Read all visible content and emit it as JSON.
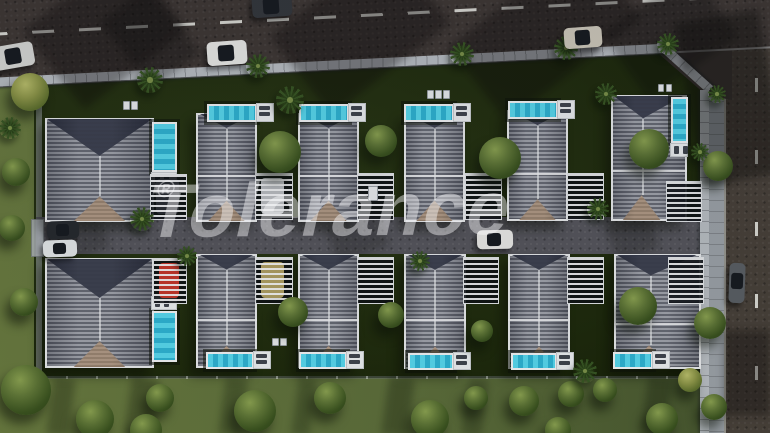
{
  "scene": {
    "type": "aerial-3d-render",
    "subject": "Gated residential complex of twelve detached villas with private pools, slatted carport pergolas, palm trees, an internal street, perimeter wall, main road with traffic at top and side road at right",
    "watermark": {
      "text": "Tolerance",
      "registered_mark": "®"
    }
  },
  "palette": {
    "main_road": "#3e3734",
    "side_road": "#474039",
    "inner_road": "#55555c",
    "sidewalk": "#9aa0a6",
    "wall": "#b7bcc1",
    "lawn_inner": "#202c0e",
    "lawn_outer": "#5b6c3a",
    "roof_stripe_light": "#9a9da6",
    "roof_stripe_dark": "#5e616c",
    "roof_gable_dark": "#2f3343",
    "roof_gable_tan": "#ab937e",
    "pool_water": "#3fc8e2",
    "pool_deck": "#e9ecee",
    "pergola_slat": "#f0f1f3",
    "lane_marking": "#d8d8d2",
    "tree_green": "#4e6530",
    "palm_green": "#33501f",
    "watermark_color": "rgba(250,250,252,0.45)"
  },
  "villas": [
    {
      "id": "villa-1",
      "row": "top",
      "x": 45,
      "y": 118,
      "w": 105,
      "h": 100,
      "type": "big"
    },
    {
      "id": "villa-2",
      "row": "top",
      "x": 196,
      "y": 113,
      "w": 57,
      "h": 105,
      "type": "std"
    },
    {
      "id": "villa-3",
      "row": "top",
      "x": 298,
      "y": 113,
      "w": 57,
      "h": 105,
      "type": "std"
    },
    {
      "id": "villa-4",
      "row": "top",
      "x": 404,
      "y": 113,
      "w": 57,
      "h": 105,
      "type": "std"
    },
    {
      "id": "villa-5",
      "row": "top",
      "x": 507,
      "y": 110,
      "w": 57,
      "h": 107,
      "type": "std"
    },
    {
      "id": "villa-6",
      "row": "top",
      "x": 611,
      "y": 95,
      "w": 72,
      "h": 122,
      "type": "wide"
    },
    {
      "id": "villa-7",
      "row": "bottom",
      "x": 45,
      "y": 258,
      "w": 105,
      "h": 106,
      "type": "big"
    },
    {
      "id": "villa-8",
      "row": "bottom",
      "x": 196,
      "y": 254,
      "w": 57,
      "h": 110,
      "type": "std"
    },
    {
      "id": "villa-9",
      "row": "bottom",
      "x": 298,
      "y": 254,
      "w": 57,
      "h": 110,
      "type": "std"
    },
    {
      "id": "villa-10",
      "row": "bottom",
      "x": 404,
      "y": 254,
      "w": 58,
      "h": 111,
      "type": "std"
    },
    {
      "id": "villa-11",
      "row": "bottom",
      "x": 508,
      "y": 254,
      "w": 58,
      "h": 111,
      "type": "std"
    },
    {
      "id": "villa-12",
      "row": "bottom",
      "x": 614,
      "y": 254,
      "w": 83,
      "h": 111,
      "type": "wide"
    }
  ],
  "pools": [
    {
      "x": 152,
      "y": 122,
      "w": 21,
      "h": 46,
      "deck": "bottom"
    },
    {
      "x": 207,
      "y": 104,
      "w": 46,
      "h": 14,
      "deck": "right"
    },
    {
      "x": 299,
      "y": 104,
      "w": 46,
      "h": 14,
      "deck": "right"
    },
    {
      "x": 404,
      "y": 104,
      "w": 46,
      "h": 14,
      "deck": "right"
    },
    {
      "x": 508,
      "y": 101,
      "w": 46,
      "h": 14,
      "deck": "right"
    },
    {
      "x": 671,
      "y": 97,
      "w": 13,
      "h": 42,
      "deck": "bottom"
    },
    {
      "x": 152,
      "y": 311,
      "w": 21,
      "h": 47,
      "deck": "top"
    },
    {
      "x": 206,
      "y": 352,
      "w": 44,
      "h": 13,
      "deck": "right"
    },
    {
      "x": 299,
      "y": 352,
      "w": 44,
      "h": 13,
      "deck": "right"
    },
    {
      "x": 408,
      "y": 353,
      "w": 42,
      "h": 13,
      "deck": "right"
    },
    {
      "x": 511,
      "y": 353,
      "w": 42,
      "h": 13,
      "deck": "right"
    },
    {
      "x": 613,
      "y": 352,
      "w": 36,
      "h": 13,
      "deck": "right"
    }
  ],
  "pergolas": [
    {
      "x": 150,
      "y": 174,
      "w": 35,
      "h": 44,
      "car": "#2a2d33"
    },
    {
      "x": 255,
      "y": 173,
      "w": 36,
      "h": 45,
      "car": "#b9bcc0"
    },
    {
      "x": 357,
      "y": 173,
      "w": 35,
      "h": 45
    },
    {
      "x": 465,
      "y": 173,
      "w": 35,
      "h": 45
    },
    {
      "x": 567,
      "y": 173,
      "w": 35,
      "h": 45
    },
    {
      "x": 666,
      "y": 181,
      "w": 34,
      "h": 39
    },
    {
      "x": 153,
      "y": 258,
      "w": 32,
      "h": 44,
      "car": "#c23529"
    },
    {
      "x": 255,
      "y": 257,
      "w": 36,
      "h": 45,
      "car": "#ad9d62"
    },
    {
      "x": 357,
      "y": 257,
      "w": 35,
      "h": 45
    },
    {
      "x": 463,
      "y": 257,
      "w": 34,
      "h": 45
    },
    {
      "x": 567,
      "y": 257,
      "w": 35,
      "h": 45
    },
    {
      "x": 668,
      "y": 257,
      "w": 34,
      "h": 45
    }
  ],
  "cars": [
    {
      "x": -6,
      "y": 44,
      "w": 40,
      "h": 24,
      "angle": -10,
      "color": "#d6d7d4",
      "location": "main-road"
    },
    {
      "x": 252,
      "y": -5,
      "w": 40,
      "h": 22,
      "angle": -4,
      "color": "#34373c",
      "location": "main-road"
    },
    {
      "x": 207,
      "y": 41,
      "w": 40,
      "h": 24,
      "angle": -4,
      "color": "#e9e9e6",
      "location": "main-road"
    },
    {
      "x": 564,
      "y": 27,
      "w": 38,
      "h": 21,
      "angle": -4,
      "color": "#cdc8ba",
      "location": "main-road"
    },
    {
      "x": 729,
      "y": 263,
      "w": 16,
      "h": 40,
      "angle": 2,
      "color": "#595e63",
      "location": "side-road"
    },
    {
      "x": 477,
      "y": 230,
      "w": 36,
      "h": 19,
      "angle": -1,
      "color": "#e8e8e5",
      "location": "inner-road"
    },
    {
      "x": 47,
      "y": 221,
      "w": 32,
      "h": 18,
      "angle": -2,
      "color": "#26292e",
      "location": "inner-road"
    },
    {
      "x": 43,
      "y": 240,
      "w": 34,
      "h": 17,
      "angle": -2,
      "color": "#e2e5e7",
      "location": "inner-road"
    }
  ],
  "trees": {
    "palms": [
      {
        "x": 150,
        "y": 80,
        "r": 13
      },
      {
        "x": 258,
        "y": 66,
        "r": 12
      },
      {
        "x": 462,
        "y": 54,
        "r": 12
      },
      {
        "x": 566,
        "y": 48,
        "r": 12
      },
      {
        "x": 668,
        "y": 44,
        "r": 11
      },
      {
        "x": 290,
        "y": 100,
        "r": 14
      },
      {
        "x": 606,
        "y": 94,
        "r": 11
      },
      {
        "x": 717,
        "y": 94,
        "r": 9
      },
      {
        "x": 10,
        "y": 128,
        "r": 11
      },
      {
        "x": 142,
        "y": 219,
        "r": 12
      },
      {
        "x": 187,
        "y": 256,
        "r": 10
      },
      {
        "x": 420,
        "y": 261,
        "r": 10
      },
      {
        "x": 598,
        "y": 209,
        "r": 11
      },
      {
        "x": 585,
        "y": 371,
        "r": 12
      },
      {
        "x": 700,
        "y": 152,
        "r": 9
      }
    ],
    "round": [
      {
        "x": 280,
        "y": 152,
        "r": 21
      },
      {
        "x": 381,
        "y": 141,
        "r": 16
      },
      {
        "x": 500,
        "y": 158,
        "r": 21
      },
      {
        "x": 649,
        "y": 149,
        "r": 20
      },
      {
        "x": 293,
        "y": 312,
        "r": 15
      },
      {
        "x": 391,
        "y": 315,
        "r": 13
      },
      {
        "x": 638,
        "y": 306,
        "r": 19
      },
      {
        "x": 482,
        "y": 331,
        "r": 11
      },
      {
        "x": 718,
        "y": 166,
        "r": 15
      },
      {
        "x": 710,
        "y": 323,
        "r": 16
      },
      {
        "x": 30,
        "y": 92,
        "r": 19,
        "variant": "light"
      },
      {
        "x": 16,
        "y": 172,
        "r": 14
      },
      {
        "x": 12,
        "y": 228,
        "r": 13
      },
      {
        "x": 24,
        "y": 302,
        "r": 14
      },
      {
        "x": 26,
        "y": 390,
        "r": 25
      },
      {
        "x": 95,
        "y": 419,
        "r": 19
      },
      {
        "x": 160,
        "y": 398,
        "r": 14
      },
      {
        "x": 255,
        "y": 411,
        "r": 21
      },
      {
        "x": 330,
        "y": 398,
        "r": 16
      },
      {
        "x": 430,
        "y": 419,
        "r": 19
      },
      {
        "x": 524,
        "y": 401,
        "r": 15
      },
      {
        "x": 571,
        "y": 394,
        "r": 13
      },
      {
        "x": 605,
        "y": 390,
        "r": 12
      },
      {
        "x": 662,
        "y": 419,
        "r": 16
      },
      {
        "x": 714,
        "y": 407,
        "r": 13
      },
      {
        "x": 146,
        "y": 430,
        "r": 16
      },
      {
        "x": 558,
        "y": 430,
        "r": 13
      },
      {
        "x": 476,
        "y": 398,
        "r": 12
      },
      {
        "x": 690,
        "y": 380,
        "r": 12,
        "variant": "light"
      }
    ]
  },
  "utility_boxes": [
    {
      "x": 123,
      "y": 101,
      "w": 5,
      "h": 7
    },
    {
      "x": 131,
      "y": 101,
      "w": 5,
      "h": 7
    },
    {
      "x": 427,
      "y": 90,
      "w": 5,
      "h": 7
    },
    {
      "x": 435,
      "y": 90,
      "w": 5,
      "h": 7
    },
    {
      "x": 443,
      "y": 90,
      "w": 5,
      "h": 7
    },
    {
      "x": 658,
      "y": 84,
      "w": 4,
      "h": 6
    },
    {
      "x": 666,
      "y": 84,
      "w": 4,
      "h": 6
    },
    {
      "x": 272,
      "y": 338,
      "w": 5,
      "h": 6
    },
    {
      "x": 280,
      "y": 338,
      "w": 5,
      "h": 6
    },
    {
      "x": 368,
      "y": 186,
      "w": 8,
      "h": 13
    }
  ],
  "road_shadows": [
    {
      "x": 40,
      "y": -20,
      "w": 130,
      "h": 100,
      "angle": -38,
      "opacity": 0.35
    },
    {
      "x": 120,
      "y": -5,
      "w": 60,
      "h": 85,
      "angle": -38,
      "opacity": 0.3
    },
    {
      "x": 285,
      "y": -20,
      "w": 150,
      "h": 100,
      "angle": -38,
      "opacity": 0.35
    },
    {
      "x": 460,
      "y": -15,
      "w": 170,
      "h": 95,
      "angle": -38,
      "opacity": 0.35
    },
    {
      "x": 615,
      "y": -5,
      "w": 110,
      "h": 80,
      "angle": -35,
      "opacity": 0.3
    },
    {
      "x": 688,
      "y": 15,
      "w": 85,
      "h": 165,
      "angle": -10,
      "opacity": 0.4
    },
    {
      "x": 724,
      "y": 330,
      "w": 46,
      "h": 85,
      "angle": 0,
      "opacity": 0.35
    },
    {
      "x": 60,
      "y": 218,
      "w": 45,
      "h": 38,
      "angle": -20,
      "opacity": 0.22
    },
    {
      "x": 330,
      "y": 218,
      "w": 55,
      "h": 38,
      "angle": -20,
      "opacity": 0.22
    },
    {
      "x": 610,
      "y": 218,
      "w": 45,
      "h": 38,
      "angle": -20,
      "opacity": 0.22
    }
  ],
  "lawn_shadows": [
    {
      "x": 50,
      "y": 378,
      "w": 22,
      "h": 58,
      "angle": 8,
      "opacity": 0.3
    },
    {
      "x": 128,
      "y": 378,
      "w": 28,
      "h": 58,
      "angle": 8,
      "opacity": 0.3
    },
    {
      "x": 222,
      "y": 378,
      "w": 22,
      "h": 58,
      "angle": 8,
      "opacity": 0.28
    },
    {
      "x": 295,
      "y": 378,
      "w": 18,
      "h": 58,
      "angle": 8,
      "opacity": 0.28
    },
    {
      "x": 385,
      "y": 378,
      "w": 26,
      "h": 58,
      "angle": 8,
      "opacity": 0.3
    },
    {
      "x": 465,
      "y": 378,
      "w": 20,
      "h": 58,
      "angle": 8,
      "opacity": 0.26
    },
    {
      "x": 645,
      "y": 378,
      "w": 24,
      "h": 50,
      "angle": 8,
      "opacity": 0.3
    }
  ]
}
